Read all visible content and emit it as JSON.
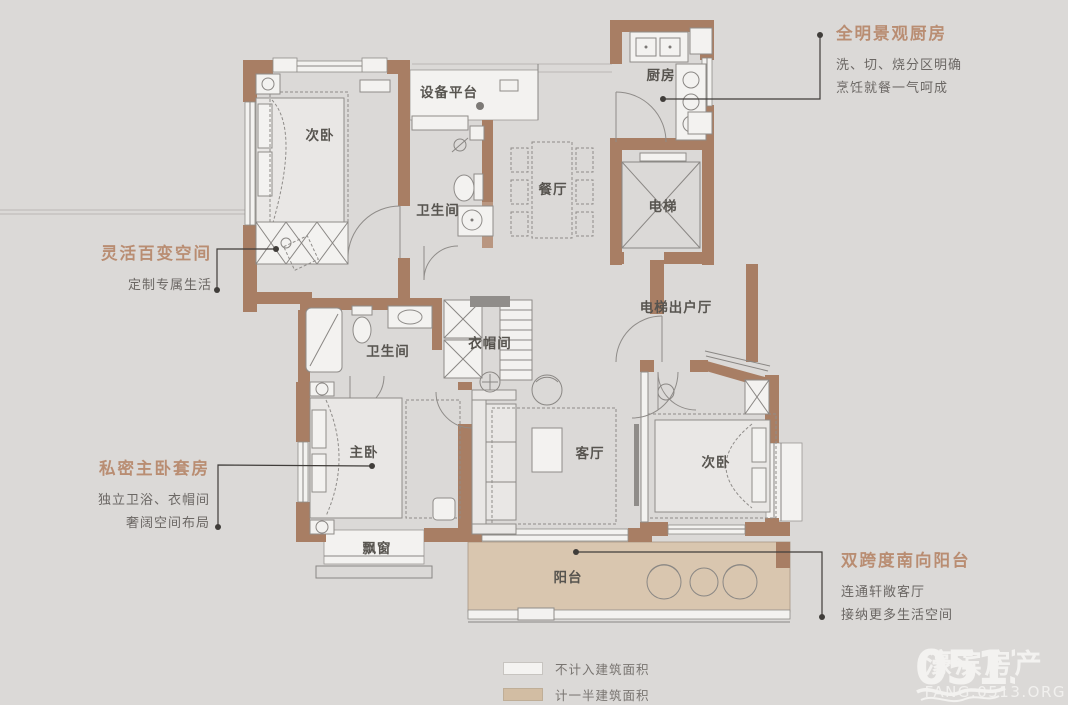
{
  "colors": {
    "background": "#dbd9d7",
    "wall": "#a87e64",
    "balcony_fill": "#d9c6af",
    "annotation_title": "#b98d72",
    "annotation_body": "#6b6764",
    "legend_not_counted": "#f4f3f1",
    "legend_half_counted": "#d2bda3"
  },
  "plan": {
    "rooms": [
      {
        "id": "bedroom-top-left",
        "label": "次卧",
        "x": 320,
        "y": 140
      },
      {
        "id": "equipment-platform",
        "label": "设备平台",
        "x": 449,
        "y": 97
      },
      {
        "id": "bathroom-top",
        "label": "卫生间",
        "x": 438,
        "y": 215
      },
      {
        "id": "dining-room",
        "label": "餐厅",
        "x": 553,
        "y": 194
      },
      {
        "id": "kitchen",
        "label": "厨房",
        "x": 661,
        "y": 80
      },
      {
        "id": "elevator",
        "label": "电梯",
        "x": 663,
        "y": 211
      },
      {
        "id": "elevator-lobby",
        "label": "电梯出户厅",
        "x": 676,
        "y": 312
      },
      {
        "id": "bathroom-middle",
        "label": "卫生间",
        "x": 388,
        "y": 356
      },
      {
        "id": "cloakroom",
        "label": "衣帽间",
        "x": 490,
        "y": 348
      },
      {
        "id": "master-bedroom",
        "label": "主卧",
        "x": 364,
        "y": 457
      },
      {
        "id": "living-room",
        "label": "客厅",
        "x": 590,
        "y": 458
      },
      {
        "id": "bedroom-bottom-right",
        "label": "次卧",
        "x": 716,
        "y": 467
      },
      {
        "id": "bay-window",
        "label": "飘窗",
        "x": 377,
        "y": 553
      },
      {
        "id": "balcony",
        "label": "阳台",
        "x": 568,
        "y": 582
      }
    ]
  },
  "annotations": [
    {
      "id": "kitchen-note",
      "title": "全明景观厨房",
      "lines": [
        "洗、切、烧分区明确",
        "烹饪就餐一气呵成"
      ]
    },
    {
      "id": "flex-note",
      "title": "灵活百变空间",
      "lines": [
        "定制专属生活"
      ]
    },
    {
      "id": "master-note",
      "title": "私密主卧套房",
      "lines": [
        "独立卫浴、衣帽间",
        "奢阔空间布局"
      ]
    },
    {
      "id": "balcony-note",
      "title": "双跨度南向阳台",
      "lines": [
        "连通轩敞客厅",
        "接纳更多生活空间"
      ]
    }
  ],
  "legend": {
    "items": [
      {
        "id": "not-counted",
        "label": "不计入建筑面积"
      },
      {
        "id": "half-counted",
        "label": "计一半建筑面积"
      }
    ]
  },
  "watermark": {
    "logo": "0513",
    "name": "濠滨房产",
    "url": "FANG.0513.ORG"
  }
}
